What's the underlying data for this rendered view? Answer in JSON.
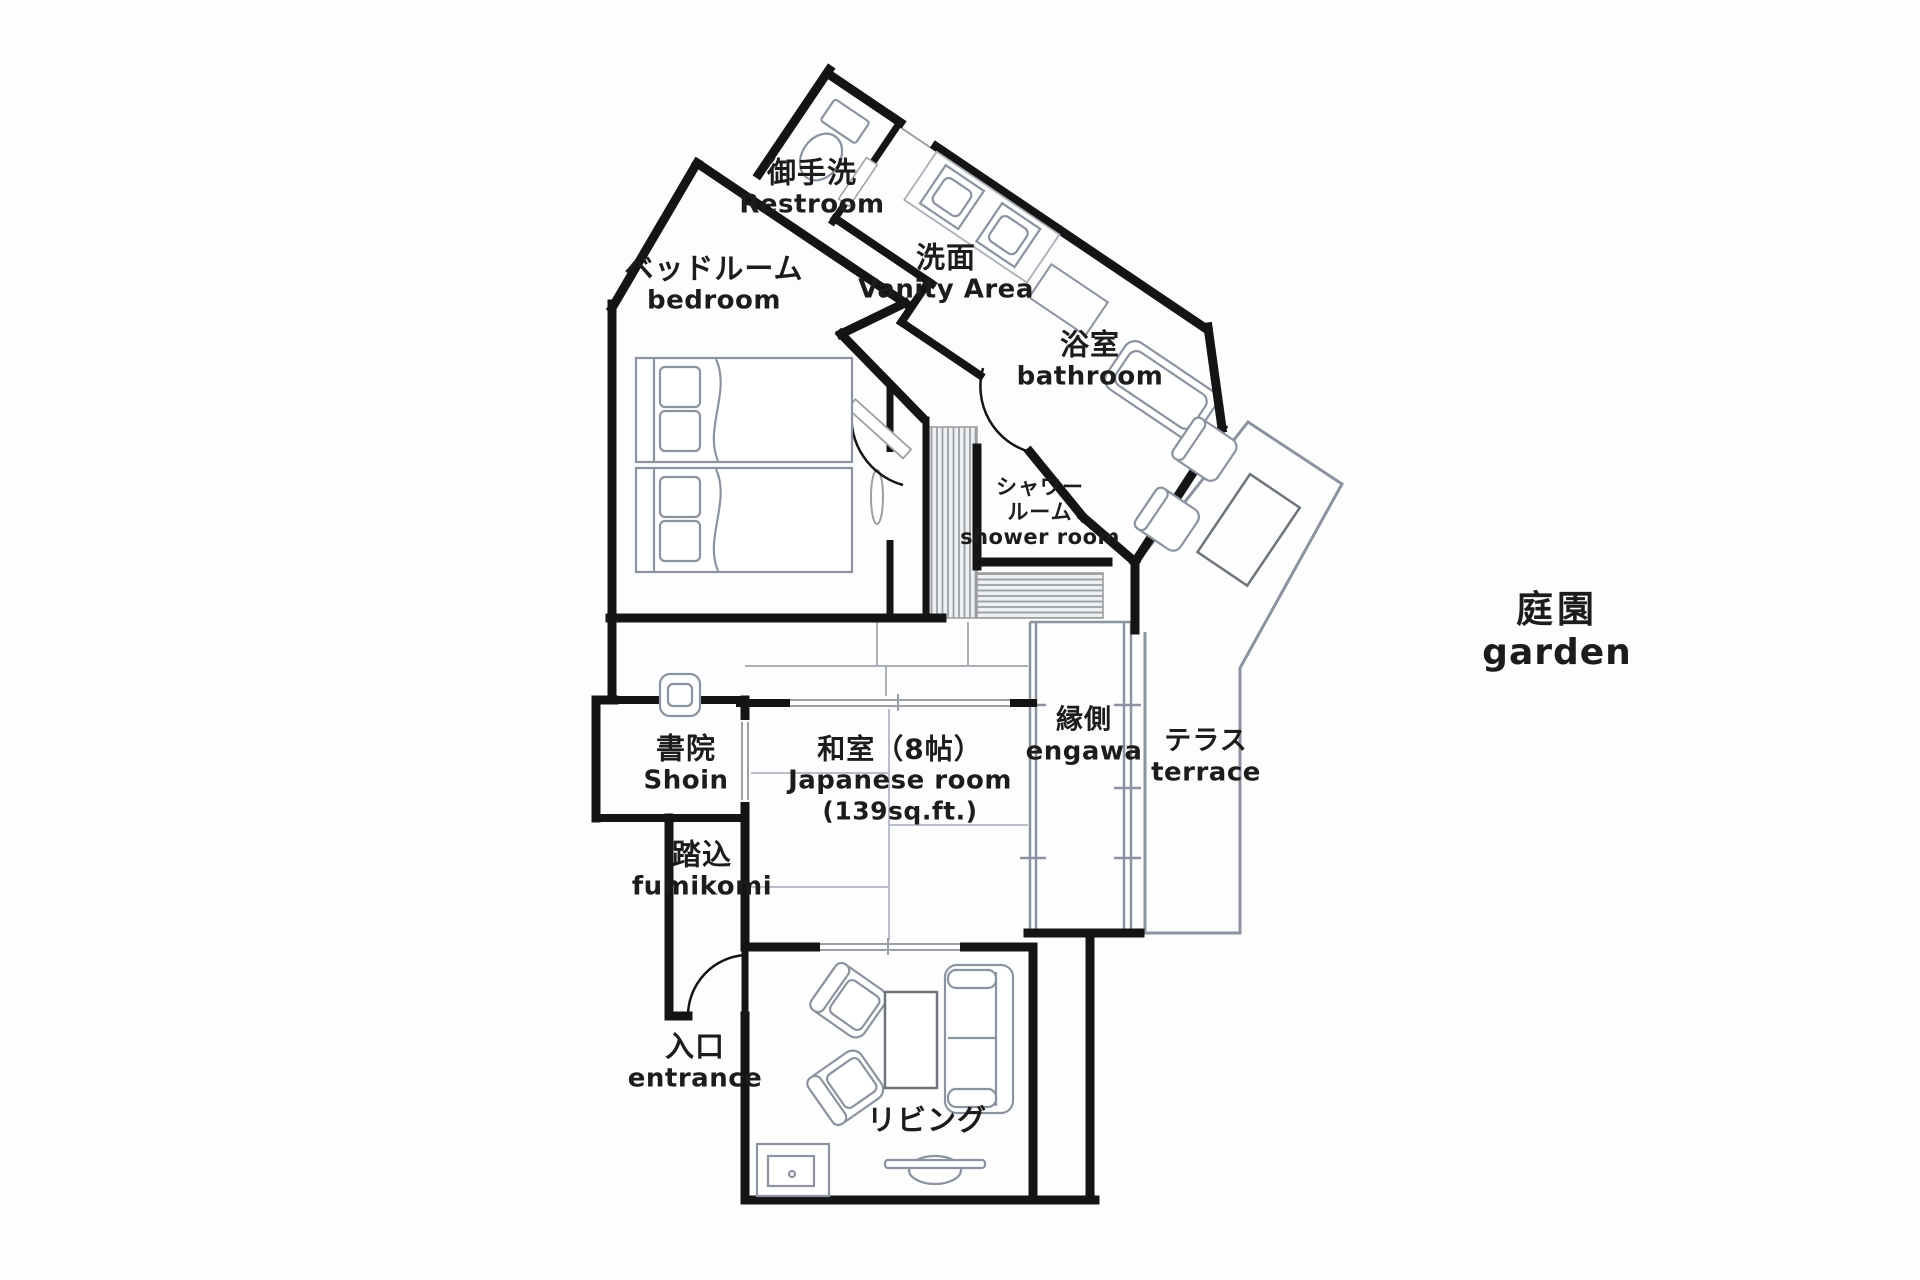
{
  "title": "Japanese suite floor plan",
  "colors": {
    "wall": "#141414",
    "furniture_line": "#8b93a0",
    "light_line": "#b9bfc8",
    "text": "#1c1c1c",
    "background": "#fdfdfd"
  },
  "labels": [
    {
      "id": "restroom",
      "jp": "御手洗",
      "en": "Restroom"
    },
    {
      "id": "bedroom",
      "jp": "ベッドルーム",
      "en": "bedroom"
    },
    {
      "id": "vanity",
      "jp": "洗面",
      "en": "Vanity Area"
    },
    {
      "id": "bathroom",
      "jp": "浴室",
      "en": "bathroom"
    },
    {
      "id": "shower",
      "jp": "シャワー",
      "jp2": "ルーム",
      "en": "shower room"
    },
    {
      "id": "shoin",
      "jp": "書院",
      "en": "Shoin"
    },
    {
      "id": "japanese-room",
      "jp": "和室（8帖）",
      "en": "Japanese room",
      "extra": "(139sq.ft.)"
    },
    {
      "id": "engawa",
      "jp": "縁側",
      "en": "engawa"
    },
    {
      "id": "terrace",
      "jp": "テラス",
      "en": "terrace"
    },
    {
      "id": "fumikomi",
      "jp": "踏込",
      "en": "fumikomi"
    },
    {
      "id": "entrance",
      "jp": "入口",
      "en": "entrance"
    },
    {
      "id": "living",
      "jp": "リビング"
    },
    {
      "id": "garden",
      "jp": "庭園",
      "en": "garden"
    }
  ],
  "icons": [
    "toilet-icon",
    "sink-icon",
    "bathtub-icon",
    "bed-icon",
    "armchair-icon",
    "sofa-icon",
    "coffee-table-icon",
    "tv-icon",
    "tv-cabinet-icon",
    "outdoor-chair-icon",
    "outdoor-table-icon",
    "door-swing-icon",
    "sliding-door-icon",
    "tatami-icon",
    "deck-boards-icon"
  ]
}
